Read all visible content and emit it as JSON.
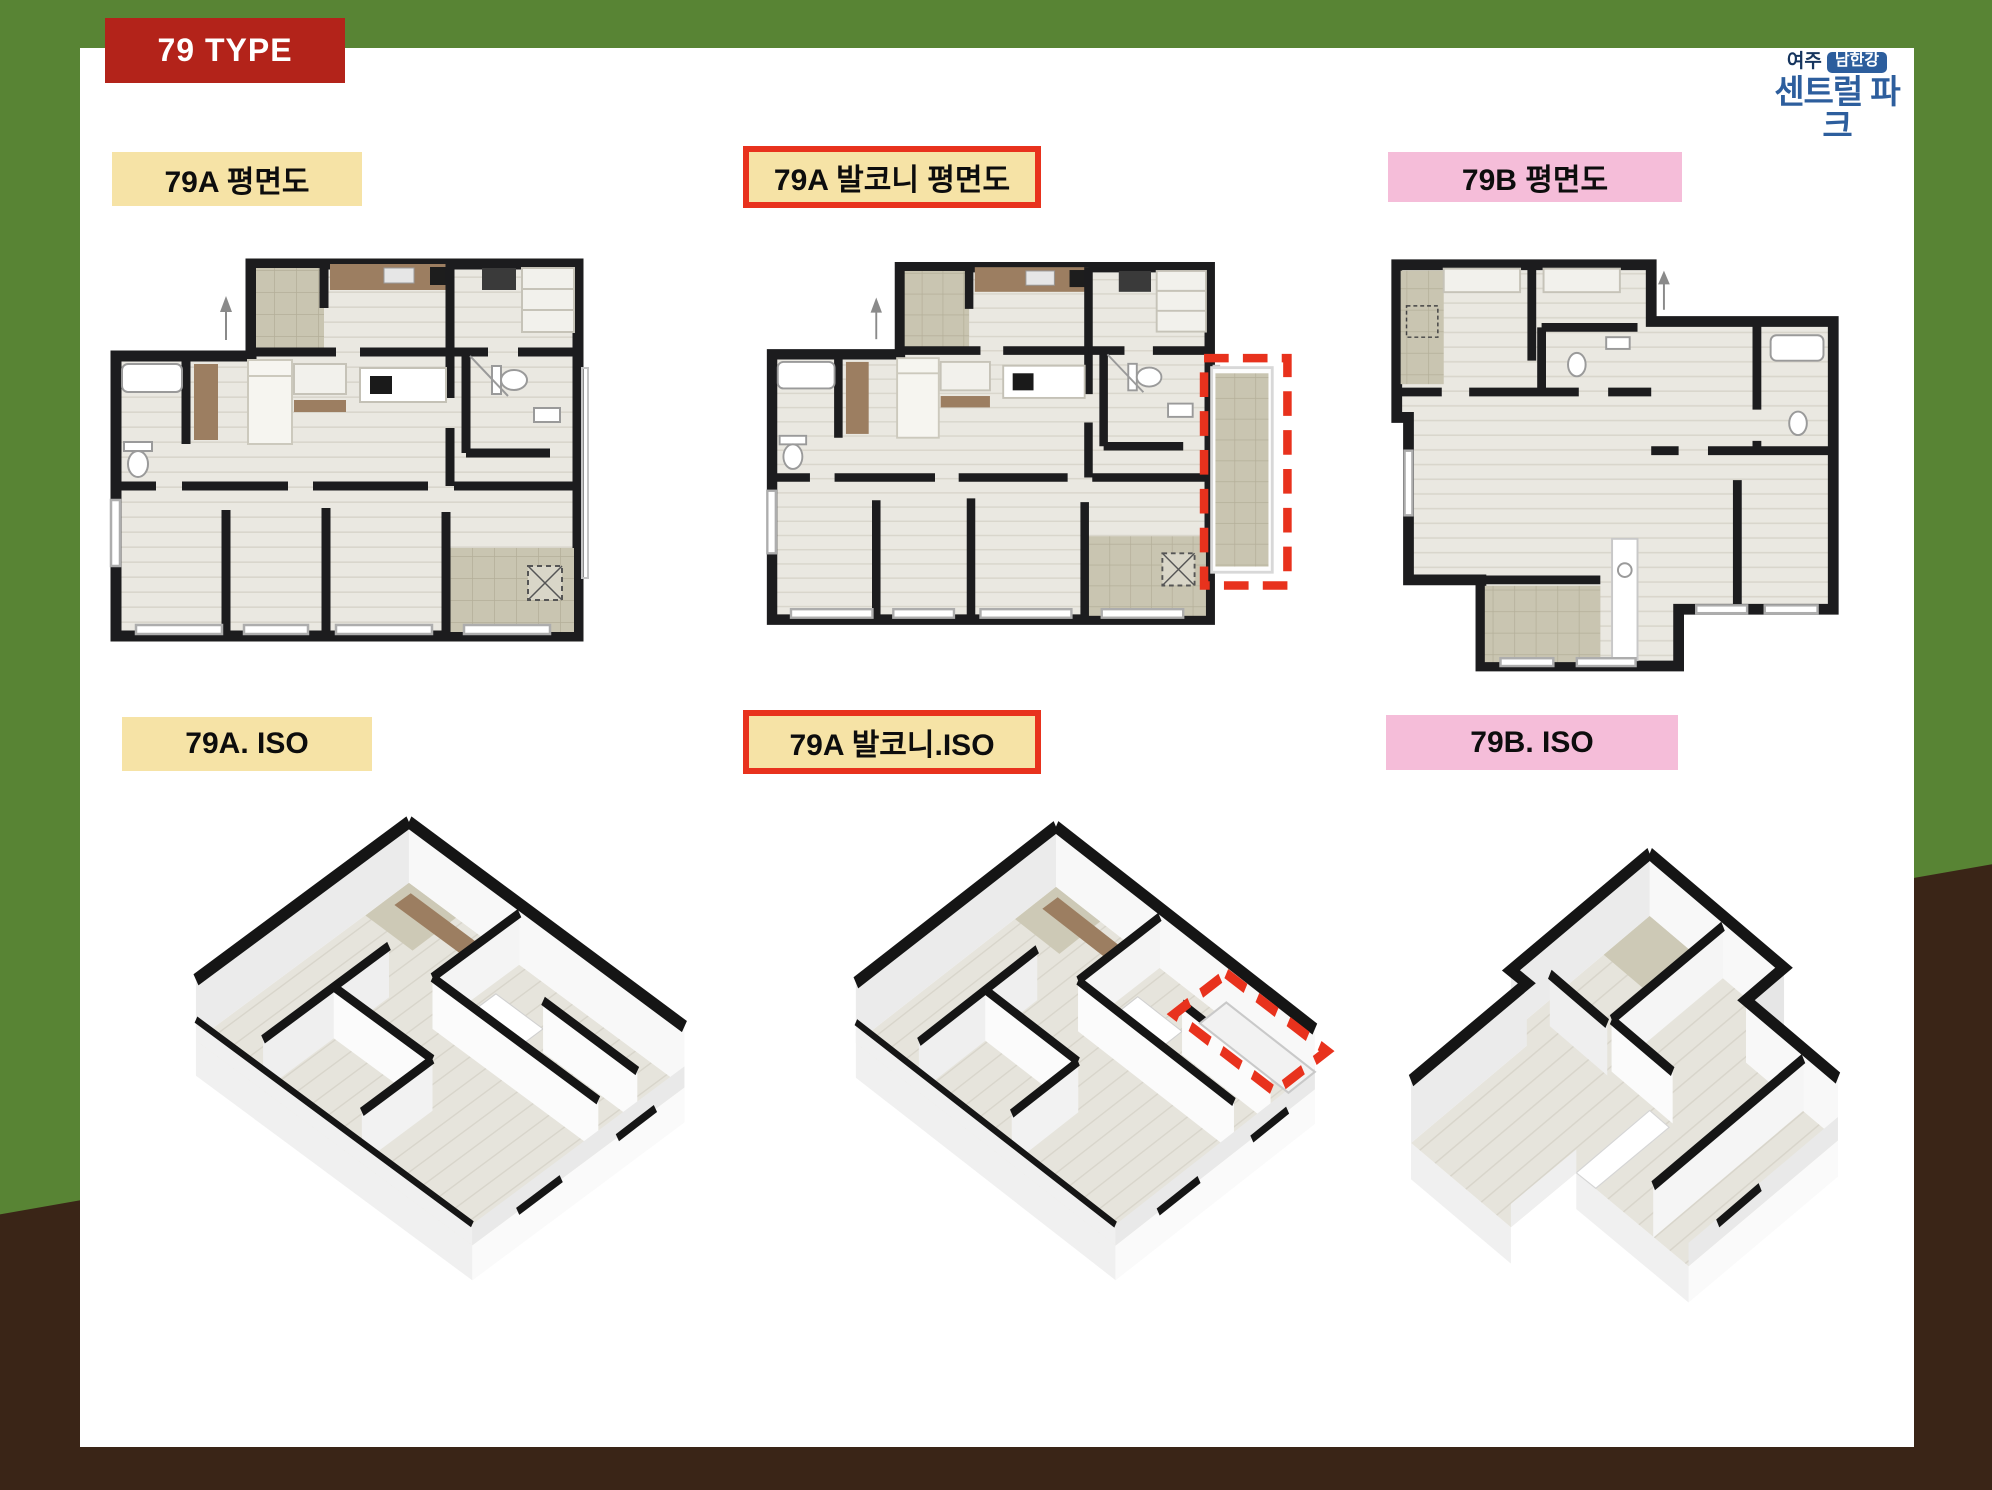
{
  "header": {
    "type_badge": "79 TYPE"
  },
  "logo": {
    "region": "여주",
    "river": "남한강",
    "name": "센트럴 파크"
  },
  "labels": {
    "plan_a": "79A 평면도",
    "plan_a_balcony": "79A 발코니 평면도",
    "plan_b": "79B 평면도",
    "iso_a": "79A. ISO",
    "iso_a_balcony": "79A 발코니.ISO",
    "iso_b": "79B. ISO"
  },
  "colors": {
    "frame_green": "#588434",
    "frame_brown": "#3a2517",
    "type_badge_red": "#b3231a",
    "highlight_red": "#e8321d",
    "label_cream": "#f6e3a6",
    "label_pink": "#f5bdd9",
    "logo_blue": "#2d5e9d",
    "logo_navy": "#16355e"
  }
}
